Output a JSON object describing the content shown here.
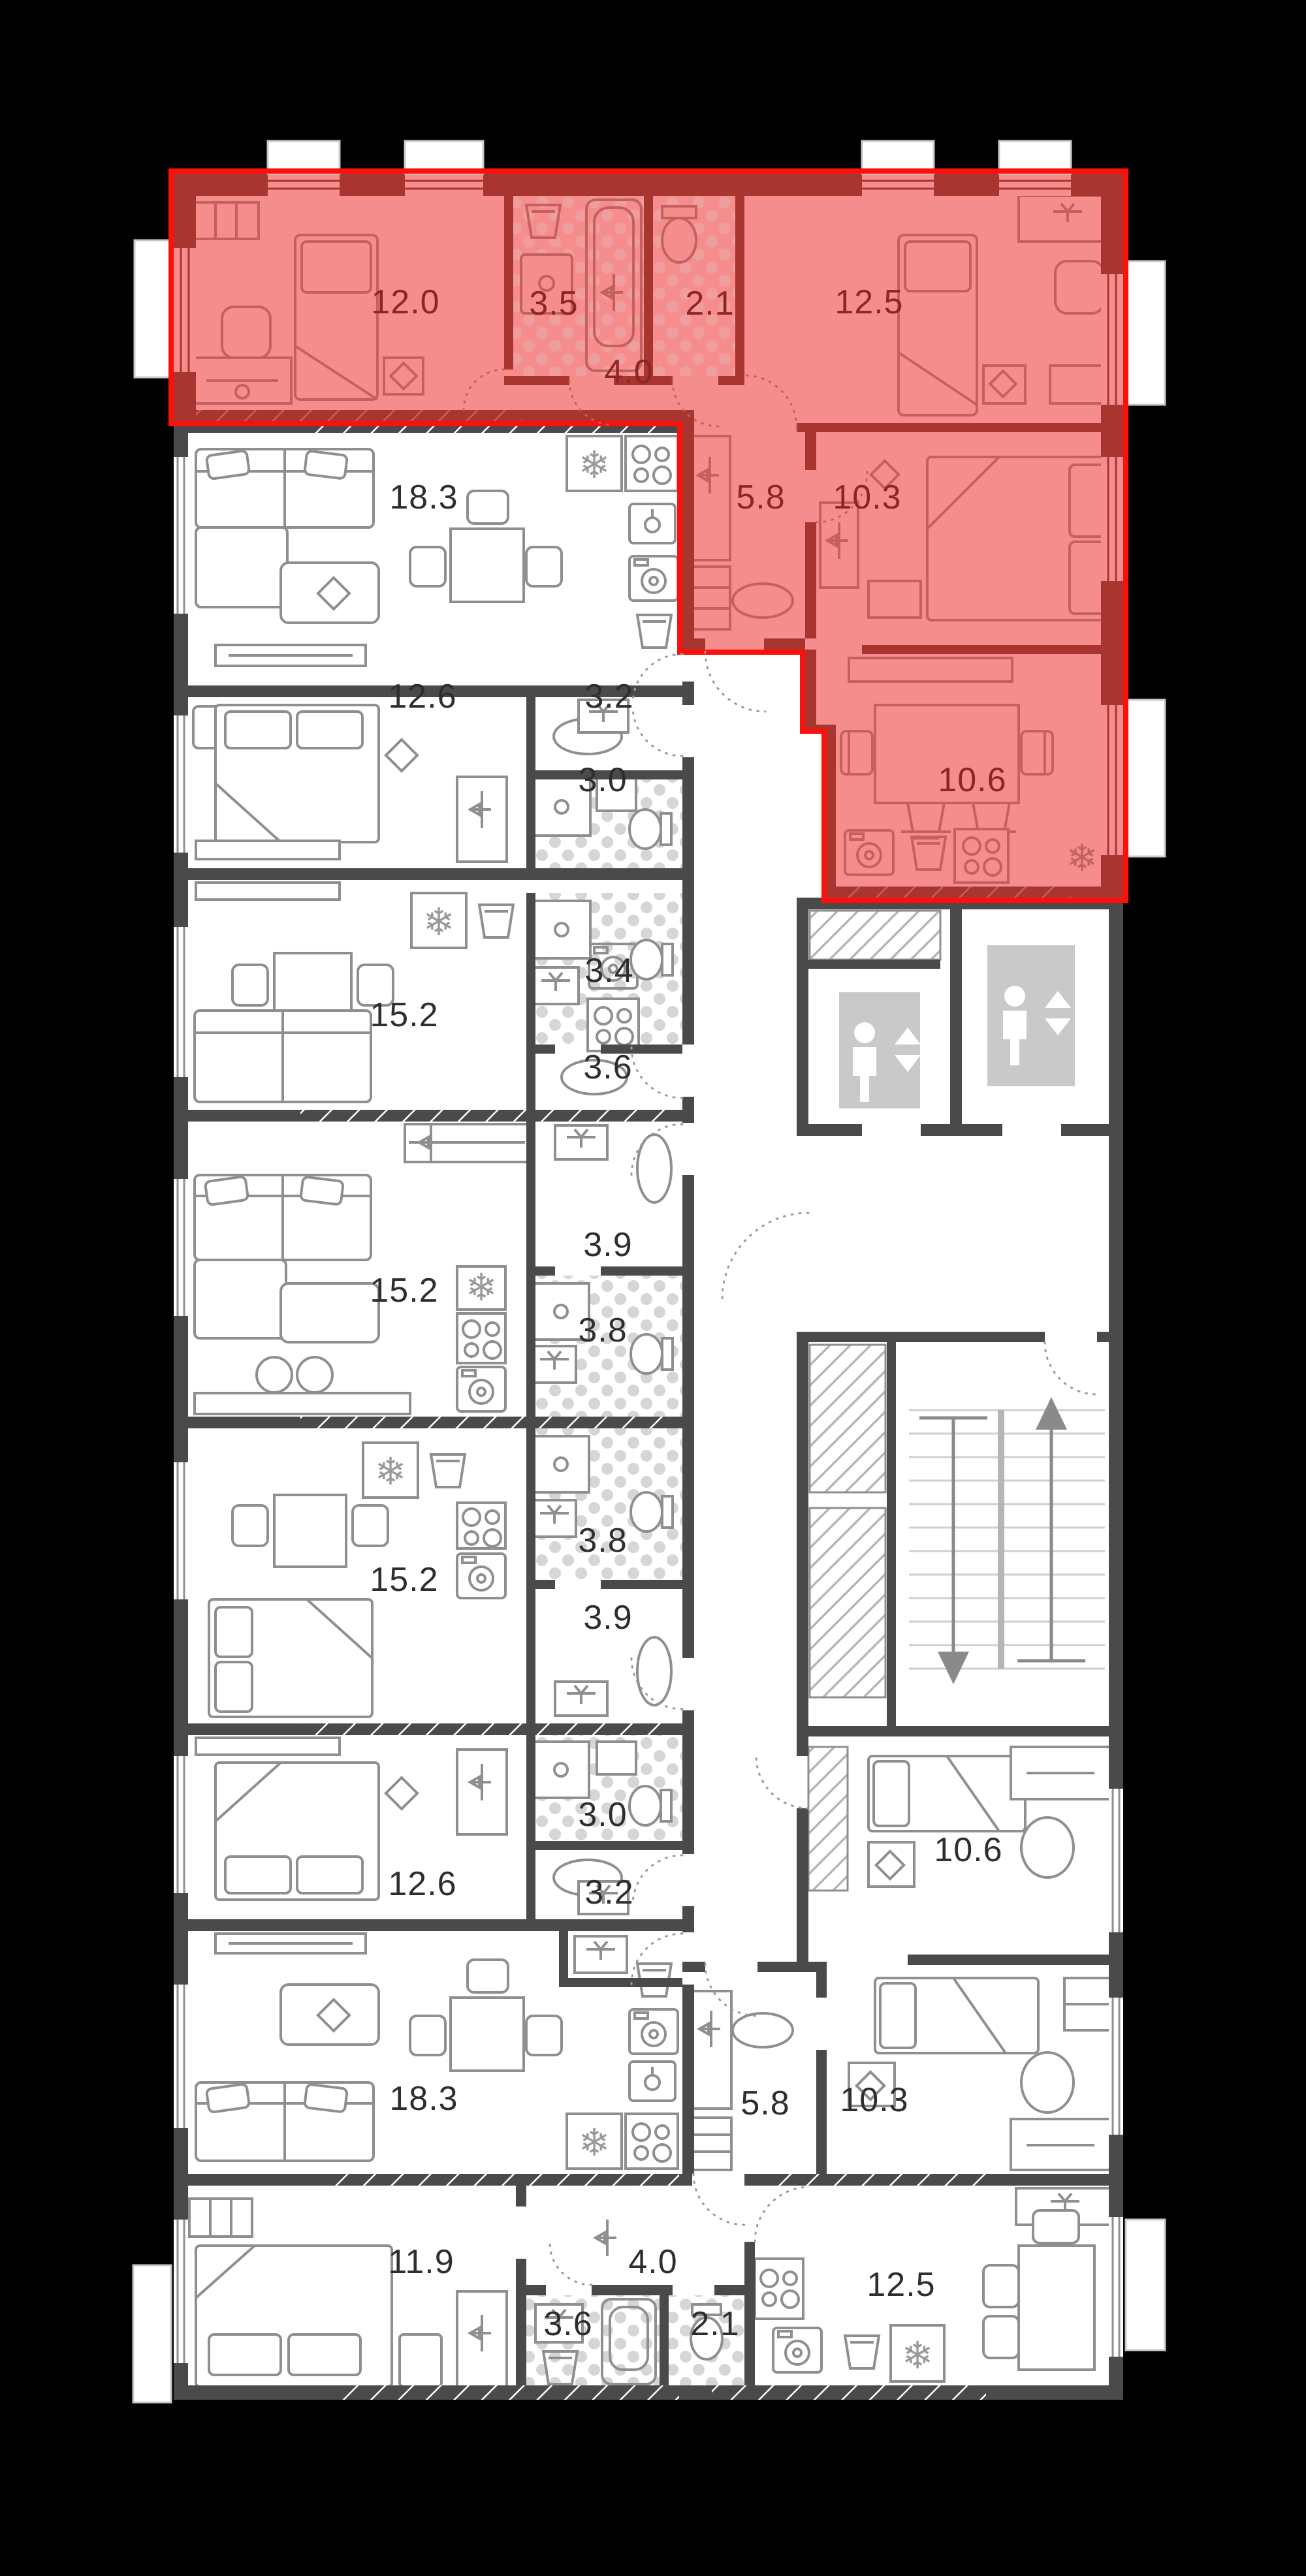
{
  "palette": {
    "background": "#000000",
    "floor": "#ffffff",
    "wall_gray": "#4a4a4a",
    "furniture_gray": "#8f8f8f",
    "label_gray": "#2e2e2e",
    "tile_gray": "#d6d6d6",
    "elevator_panel": "#c9c9c9",
    "highlight_fill": "#f68d8d",
    "highlight_wall": "#a93531",
    "highlight_furniture": "#c4615e",
    "highlight_label": "#8e2522",
    "highlight_outline": "#fb100c",
    "highlight_tile": "#ef9e9e"
  },
  "icons": {
    "fridge": "snowflake",
    "stove": "four-burners",
    "elevator": "person-with-up-down-arrows",
    "stairs_up": "arrow-up",
    "stairs_down": "arrow-down"
  },
  "rooms": [
    {
      "label": "12.0",
      "x_pct": 31.05,
      "y_pct": 11.73,
      "highlighted": true
    },
    {
      "label": "3.5",
      "x_pct": 42.4,
      "y_pct": 11.78,
      "highlighted": true
    },
    {
      "label": "2.1",
      "x_pct": 54.35,
      "y_pct": 11.78,
      "highlighted": true
    },
    {
      "label": "12.5",
      "x_pct": 66.55,
      "y_pct": 11.73,
      "highlighted": true
    },
    {
      "label": "4.0",
      "x_pct": 48.15,
      "y_pct": 14.45,
      "highlighted": true
    },
    {
      "label": "5.8",
      "x_pct": 58.25,
      "y_pct": 19.31,
      "highlighted": true
    },
    {
      "label": "10.3",
      "x_pct": 66.4,
      "y_pct": 19.31,
      "highlighted": true
    },
    {
      "label": "10.6",
      "x_pct": 74.45,
      "y_pct": 30.28,
      "highlighted": true
    },
    {
      "label": "18.3",
      "x_pct": 32.45,
      "y_pct": 19.31,
      "highlighted": false
    },
    {
      "label": "12.6",
      "x_pct": 32.35,
      "y_pct": 27.04,
      "highlighted": false
    },
    {
      "label": "3.2",
      "x_pct": 46.65,
      "y_pct": 27.04,
      "highlighted": false
    },
    {
      "label": "3.0",
      "x_pct": 46.15,
      "y_pct": 30.28,
      "highlighted": false
    },
    {
      "label": "3.4",
      "x_pct": 46.65,
      "y_pct": 37.68,
      "highlighted": false
    },
    {
      "label": "15.2",
      "x_pct": 30.95,
      "y_pct": 39.41,
      "highlighted": false
    },
    {
      "label": "3.6",
      "x_pct": 46.55,
      "y_pct": 41.43,
      "highlighted": false
    },
    {
      "label": "3.9",
      "x_pct": 46.55,
      "y_pct": 48.33,
      "highlighted": false
    },
    {
      "label": "15.2",
      "x_pct": 30.95,
      "y_pct": 50.1,
      "highlighted": false
    },
    {
      "label": "3.8",
      "x_pct": 46.15,
      "y_pct": 51.65,
      "highlighted": false
    },
    {
      "label": "3.8",
      "x_pct": 46.15,
      "y_pct": 59.81,
      "highlighted": false
    },
    {
      "label": "15.2",
      "x_pct": 30.95,
      "y_pct": 61.33,
      "highlighted": false
    },
    {
      "label": "3.9",
      "x_pct": 46.55,
      "y_pct": 62.8,
      "highlighted": false
    },
    {
      "label": "3.0",
      "x_pct": 46.15,
      "y_pct": 70.45,
      "highlighted": false
    },
    {
      "label": "10.6",
      "x_pct": 74.15,
      "y_pct": 71.82,
      "highlighted": false
    },
    {
      "label": "12.6",
      "x_pct": 32.35,
      "y_pct": 73.14,
      "highlighted": false
    },
    {
      "label": "3.2",
      "x_pct": 46.65,
      "y_pct": 73.47,
      "highlighted": false
    },
    {
      "label": "5.8",
      "x_pct": 58.6,
      "y_pct": 81.65,
      "highlighted": false
    },
    {
      "label": "10.3",
      "x_pct": 66.95,
      "y_pct": 81.53,
      "highlighted": false
    },
    {
      "label": "18.3",
      "x_pct": 32.45,
      "y_pct": 81.47,
      "highlighted": false
    },
    {
      "label": "11.9",
      "x_pct": 32.25,
      "y_pct": 87.81,
      "highlighted": false
    },
    {
      "label": "4.0",
      "x_pct": 50.0,
      "y_pct": 87.81,
      "highlighted": false
    },
    {
      "label": "3.6",
      "x_pct": 43.5,
      "y_pct": 90.22,
      "highlighted": false
    },
    {
      "label": "2.1",
      "x_pct": 54.75,
      "y_pct": 90.22,
      "highlighted": false
    },
    {
      "label": "12.5",
      "x_pct": 69.0,
      "y_pct": 88.7,
      "highlighted": false
    }
  ]
}
